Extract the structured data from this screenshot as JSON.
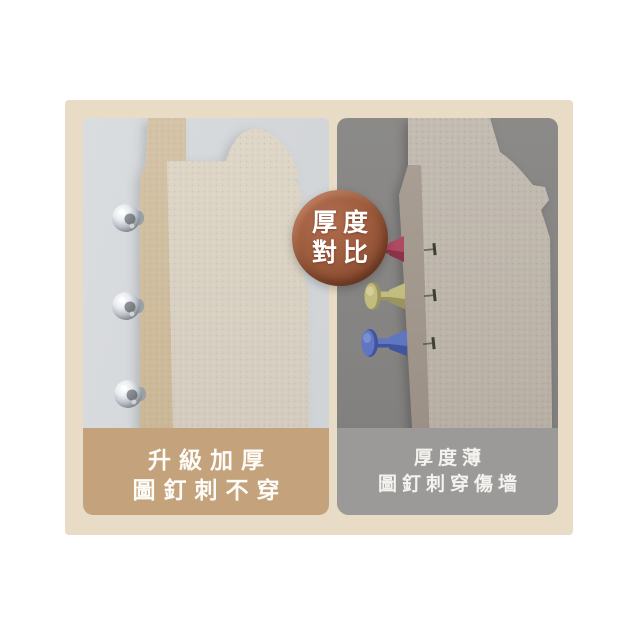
{
  "image": {
    "description": "Two-panel product comparison: thick board stops pins vs thin board pierced by pushpins",
    "background": "#ffffff",
    "frame_background": "#e9dcc6"
  },
  "badge": {
    "line1": "厚度",
    "line2": "對比",
    "background": "#9a5a3c",
    "text_color": "#ffffff"
  },
  "left_panel": {
    "background": "#d4d7da",
    "board": {
      "face_color": "#d7cfc1",
      "edge_color": "#cfc0a4"
    },
    "pins": {
      "style": "metal-ball-pins",
      "count": 3,
      "color": "#c9ced3"
    },
    "caption": {
      "line1": "升級加厚",
      "line2": "圖釘刺不穿",
      "background": "#c4a37c",
      "text_color": "#ffffff"
    }
  },
  "right_panel": {
    "background": "#858482",
    "board": {
      "face_color": "#bcb4a9",
      "edge_color": "#9e948a"
    },
    "pins": [
      {
        "name": "red-pushpin",
        "color": "#b04a63",
        "dark": "#8d3349",
        "light": "#d27b8e"
      },
      {
        "name": "yellow-pushpin",
        "color": "#c2bc7f",
        "dark": "#9a945e",
        "light": "#ddd8a4"
      },
      {
        "name": "blue-pushpin",
        "color": "#5f76c2",
        "dark": "#41549c",
        "light": "#8b9cd8"
      }
    ],
    "pin_tip_count": 3,
    "caption": {
      "line1": "厚度薄",
      "line2": "圖釘刺穿傷墙",
      "background": "#9b9a98",
      "text_color": "#ffffff"
    }
  }
}
